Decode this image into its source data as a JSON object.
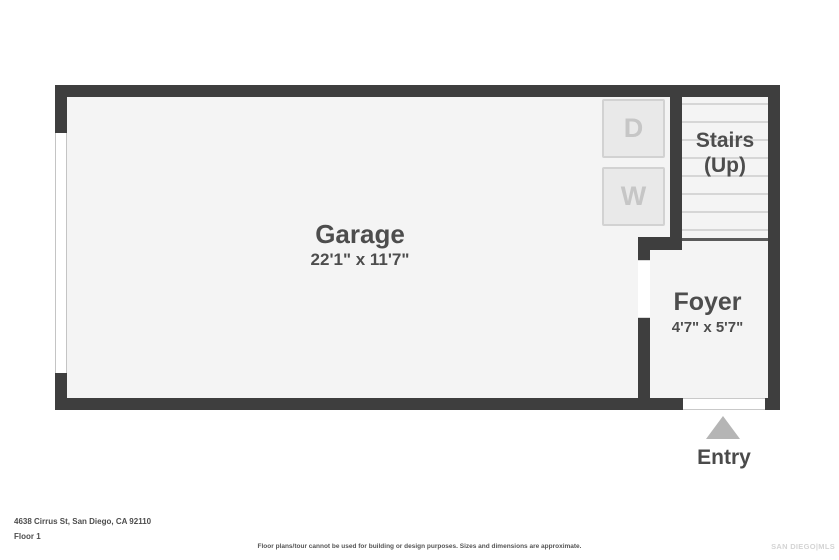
{
  "plan": {
    "garage": {
      "name": "Garage",
      "dims": "22'1\" x 11'7\""
    },
    "stairs": {
      "label_line1": "Stairs",
      "label_line2": "(Up)"
    },
    "foyer": {
      "name": "Foyer",
      "dims": "4'7\" x 5'7\""
    },
    "entry": {
      "label": "Entry"
    },
    "appliances": {
      "dryer_label": "D",
      "washer_label": "W"
    }
  },
  "footer": {
    "address": "4638 Cirrus St, San Diego, CA 92110",
    "floor": "Floor 1",
    "disclaimer": "Floor plans/tour cannot be used for building or design purposes. Sizes and dimensions are approximate.",
    "watermark": "SAN DIEGO|MLS"
  },
  "colors": {
    "wall": "#3e3e3e",
    "room_fill": "#f4f4f4",
    "appliance_fill": "#e9e9e9",
    "appliance_border": "#d2d2d2",
    "appliance_letter": "#c6c6c6",
    "stair_tread_line": "#d6d6d6",
    "label_text": "#4d4d4d",
    "entry_arrow": "#b5b5b5",
    "watermark_text": "#d4d4d4"
  }
}
